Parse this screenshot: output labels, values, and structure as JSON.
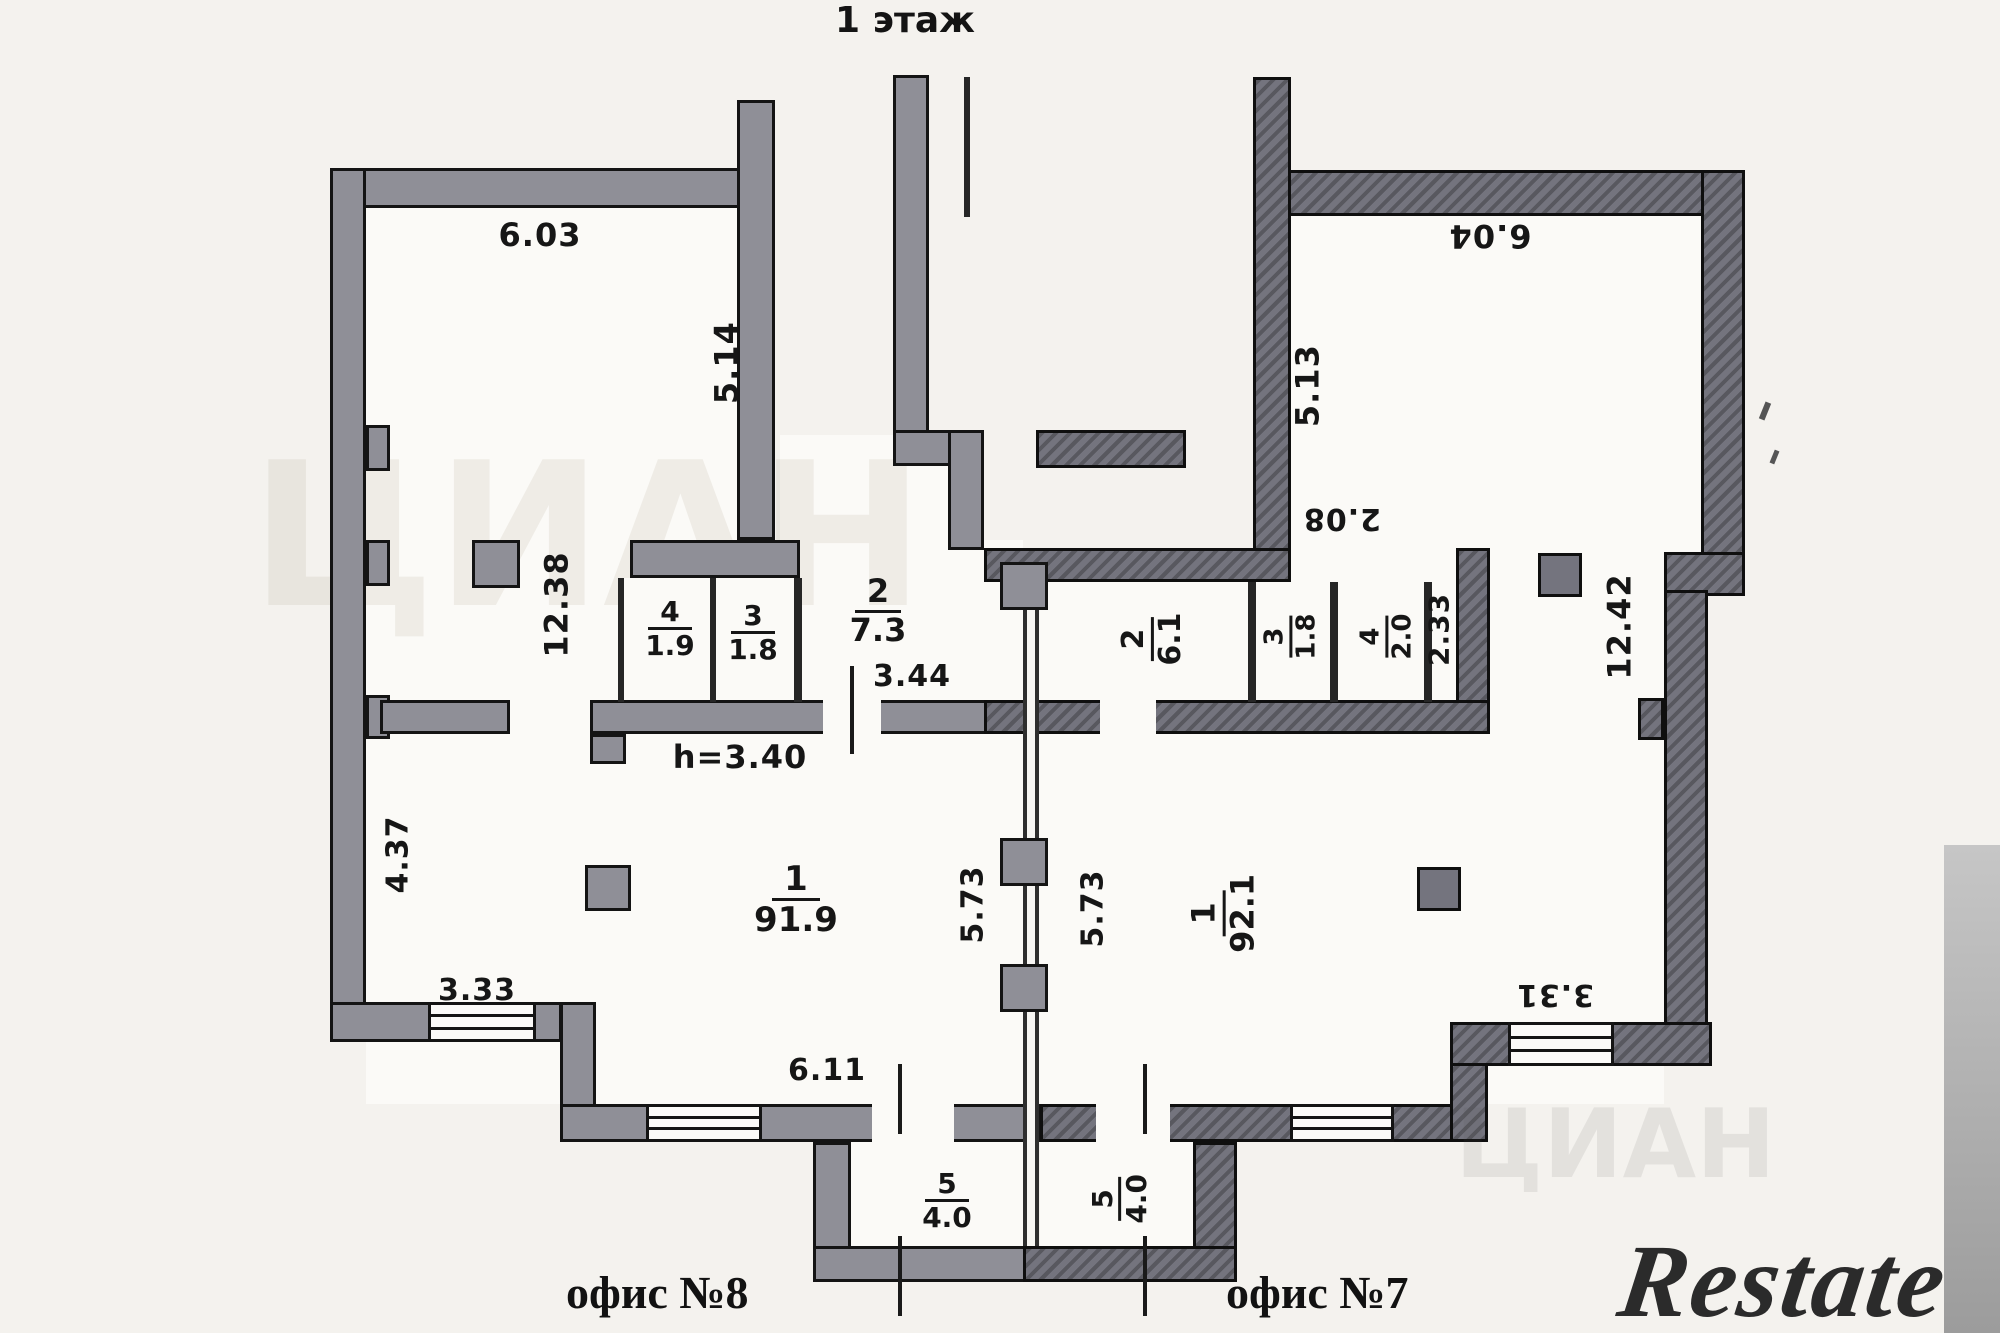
{
  "title": "1 этаж",
  "office8": {
    "name": "офис №8",
    "rooms": {
      "r1": {
        "num": "1",
        "area": "91.9"
      },
      "r2": {
        "num": "2",
        "area": "7.3"
      },
      "r3": {
        "num": "3",
        "area": "1.8"
      },
      "r4": {
        "num": "4",
        "area": "1.9"
      },
      "r5": {
        "num": "5",
        "area": "4.0"
      }
    },
    "dims": {
      "top_width": "6.03",
      "upper_right_height": "5.14",
      "total_width": "12.38",
      "left_height": "4.37",
      "bottom_left_width": "3.33",
      "bottom_width": "6.11",
      "corridor_width": "3.44",
      "ceiling_height": "h=3.40",
      "partition_height": "5.73"
    }
  },
  "office7": {
    "name": "офис №7",
    "rooms": {
      "r1": {
        "num": "1",
        "area": "92.1"
      },
      "r2": {
        "num": "2",
        "area": "6.1"
      },
      "r3": {
        "num": "3",
        "area": "1.8"
      },
      "r4": {
        "num": "4",
        "area": "2.0"
      },
      "r5": {
        "num": "5",
        "area": "4.0"
      }
    },
    "dims": {
      "top_width": "6.04",
      "upper_left_height": "5.13",
      "mid_left_height": "2.08",
      "strip_height": "2.33",
      "total_width": "12.42",
      "bottom_right_width": "3.31",
      "partition_height": "5.73"
    }
  },
  "watermarks": {
    "restate": "Restate",
    "cian": "ЦИАН"
  },
  "colors": {
    "wall_office8": "#8f8f97",
    "wall_office7": "#74747e",
    "paper": "#f4f2ee"
  }
}
